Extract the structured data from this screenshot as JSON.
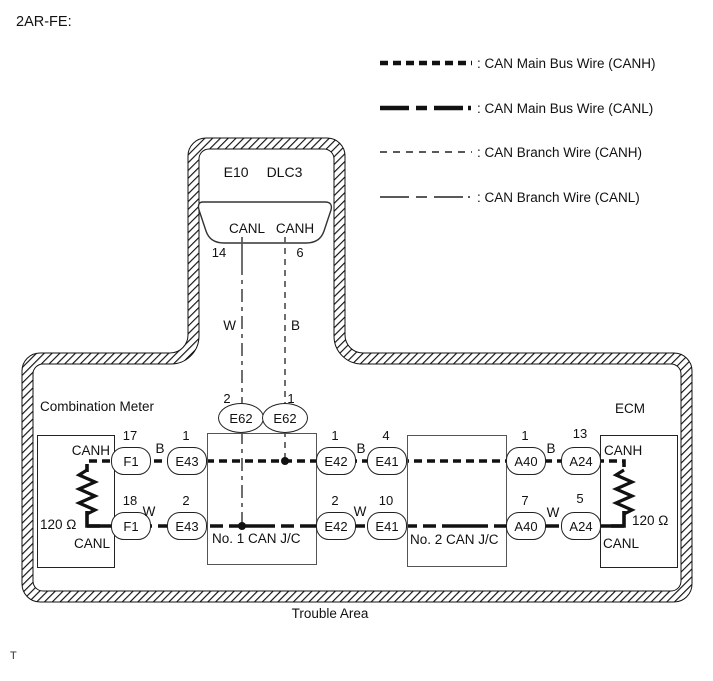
{
  "title": "2AR-FE:",
  "legend": {
    "items": [
      {
        "label": ": CAN Main Bus Wire (CANH)"
      },
      {
        "label": ": CAN Main Bus Wire (CANL)"
      },
      {
        "label": ": CAN Branch Wire (CANH)"
      },
      {
        "label": ": CAN Branch Wire (CANL)"
      }
    ]
  },
  "dlc3": {
    "station": "E10",
    "connector_label": "DLC3",
    "canl_label": "CANL",
    "canh_label": "CANH",
    "pin_canl": "14",
    "pin_canh": "6"
  },
  "branch_wires": {
    "canl_color": "W",
    "canh_color": "B"
  },
  "combination_meter": {
    "title": "Combination Meter",
    "canh": "CANH",
    "canl": "CANL",
    "resistor": "120 Ω"
  },
  "ecm": {
    "title": "ECM",
    "canh": "CANH",
    "canl": "CANL",
    "resistor": "120 Ω"
  },
  "junctions": {
    "no1": "No. 1 CAN J/C",
    "no2": "No. 2 CAN J/C"
  },
  "connectors": {
    "e62_left": {
      "label": "E62",
      "pin": "2"
    },
    "e62_right": {
      "label": "E62",
      "pin": "1"
    },
    "f1_top": {
      "label": "F1",
      "pin": "17"
    },
    "f1_bottom": {
      "label": "F1",
      "pin": "18"
    },
    "e43_top": {
      "label": "E43",
      "pin": "1"
    },
    "e43_bottom": {
      "label": "E43",
      "pin": "2"
    },
    "e42_top": {
      "label": "E42",
      "pin": "1"
    },
    "e42_bottom": {
      "label": "E42",
      "pin": "2"
    },
    "e41_top": {
      "label": "E41",
      "pin": "4"
    },
    "e41_bottom": {
      "label": "E41",
      "pin": "10"
    },
    "a40_top": {
      "label": "A40",
      "pin": "1"
    },
    "a40_bottom": {
      "label": "A40",
      "pin": "7"
    },
    "a24_top": {
      "label": "A24",
      "pin": "13"
    },
    "a24_bottom": {
      "label": "A24",
      "pin": "5"
    }
  },
  "wire_labels": {
    "canh_f1_e43": "B",
    "canl_f1_e43": "W",
    "canh_e42_e41": "B",
    "canl_e42_e41": "W",
    "canh_a40_a24": "B",
    "canl_a40_a24": "W"
  },
  "trouble_area_label": "Trouble Area",
  "footnote": "T",
  "colors": {
    "line": "#111111",
    "thin_wire": "#555555"
  }
}
